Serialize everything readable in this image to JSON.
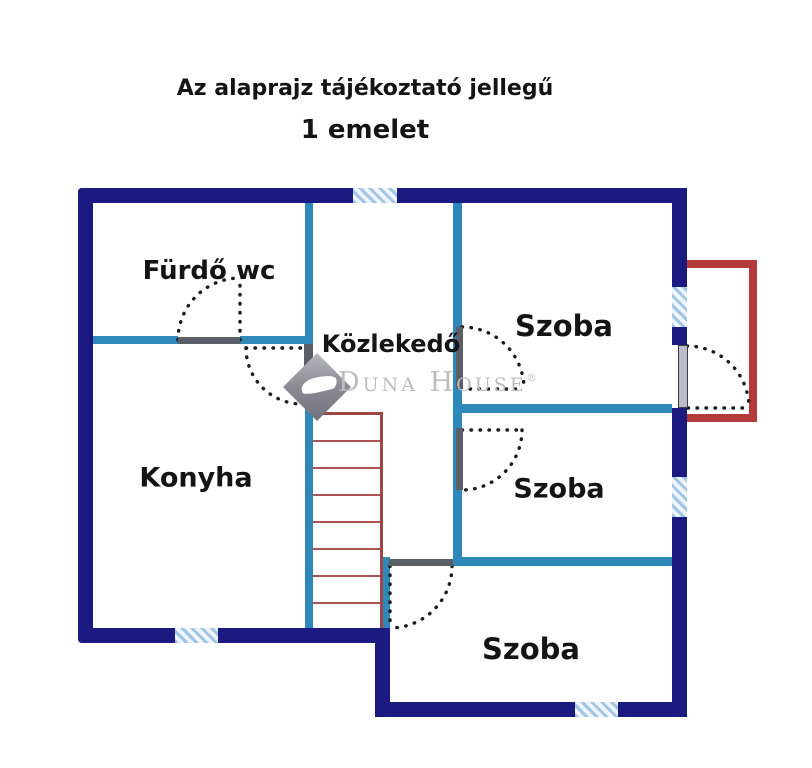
{
  "title": {
    "disclaimer": "Az alaprajz tájékoztató jellegű",
    "floor": "1 emelet"
  },
  "rooms": [
    {
      "key": "furdo",
      "label": "Fürdő wc"
    },
    {
      "key": "kozlekedo",
      "label": "Közlekedő"
    },
    {
      "key": "szoba_top",
      "label": "Szoba"
    },
    {
      "key": "szoba_middle",
      "label": "Szoba"
    },
    {
      "key": "szoba_bottom",
      "label": "Szoba"
    },
    {
      "key": "konyha",
      "label": "Konyha"
    }
  ],
  "watermark": {
    "brand": "Duna House",
    "registered_mark": "®"
  },
  "features": {
    "staircase": "stairs between hallway walls",
    "balcony": "red open outline on right side",
    "windows_count": 5,
    "doors_count": 6
  },
  "colors": {
    "wall_outer": "#1a1a80",
    "wall_inner": "#2e89ba",
    "balcony_red": "#b43a3a",
    "stairs_red": "#9c4646",
    "stairs_step": "#ab5353",
    "window_fill": "#eef5fc",
    "window_stripe": "#a2c5e6",
    "door_gray": "#5a5e66",
    "balcony_door_gray": "#b9bcc9",
    "door_swing": "#1c1c1c",
    "text": "#141414",
    "watermark_gray": "#bdbdbd",
    "background": "#ffffff"
  }
}
